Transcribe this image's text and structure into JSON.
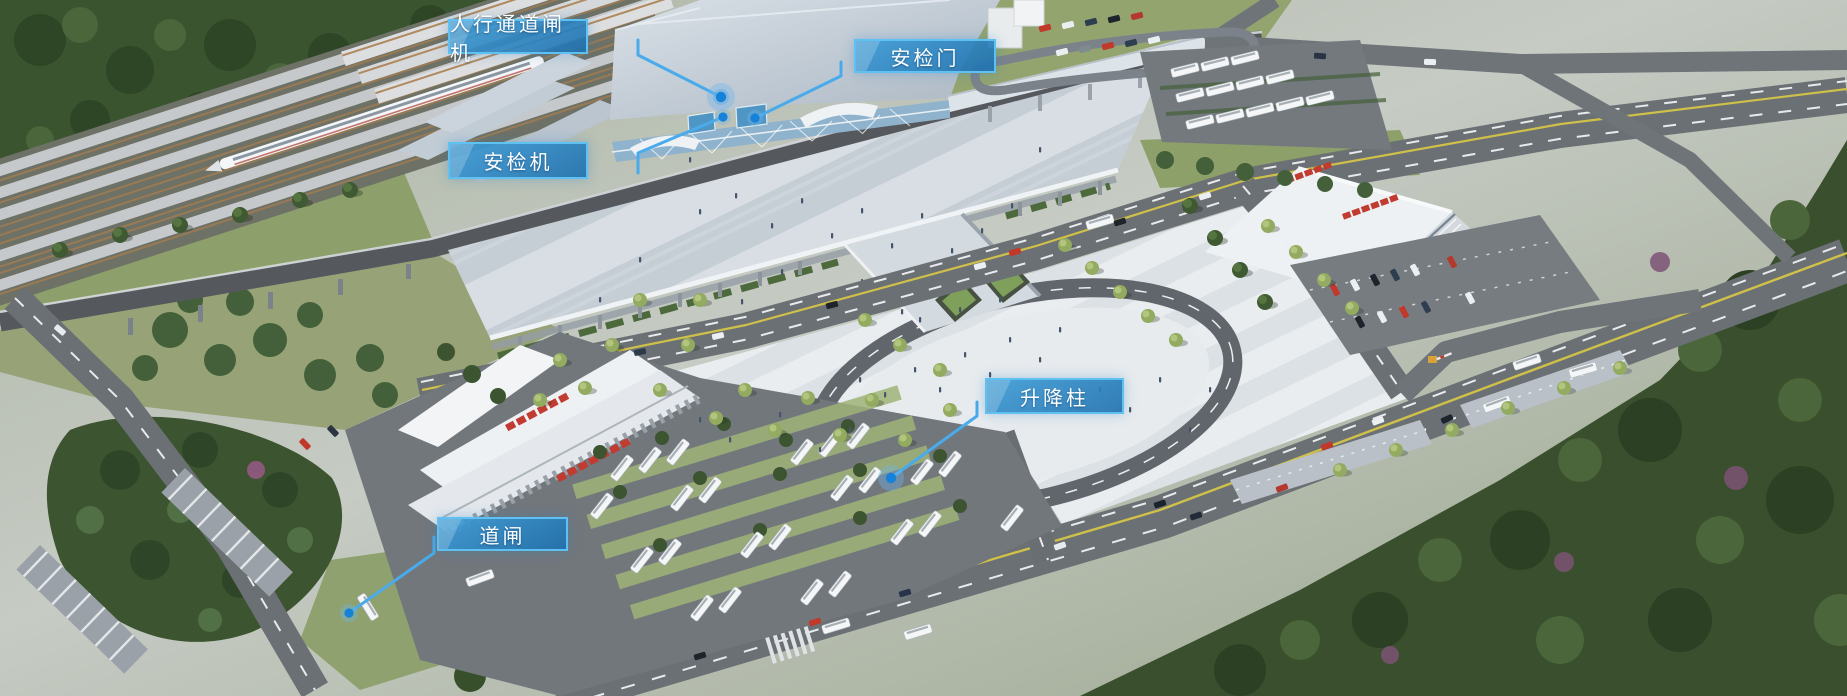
{
  "callouts": [
    {
      "id": "pedestrian-channel-gate",
      "label": "人行通道闸机"
    },
    {
      "id": "security-check-door",
      "label": "安检门"
    },
    {
      "id": "security-scanner",
      "label": "安检机"
    },
    {
      "id": "lifting-bollard",
      "label": "升降柱"
    },
    {
      "id": "barrier-gate",
      "label": "道闸"
    }
  ],
  "style": {
    "callout_background": "#2f8fc9",
    "callout_border": "#5ec1f2",
    "callout_text_color": "#ffffff",
    "leader_line_color": "#49abeb",
    "marker_dot_color": "#1581d8"
  }
}
